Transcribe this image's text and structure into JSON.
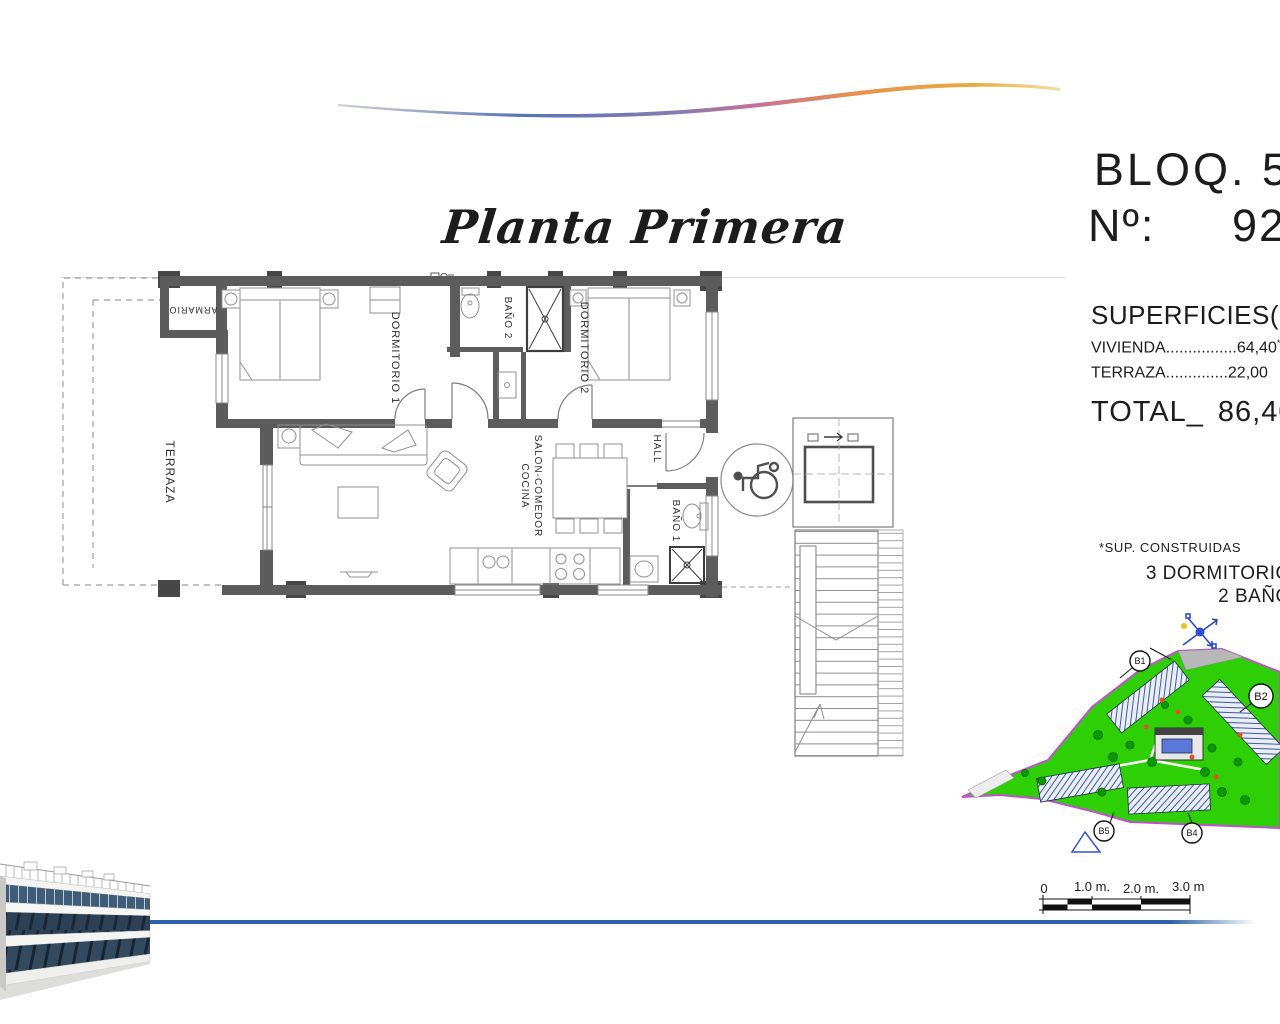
{
  "header": {
    "title": "Planta Primera"
  },
  "unit": {
    "block": "BLOQ. 5",
    "number_label": "Nº:",
    "number_value": "92"
  },
  "surfaces": {
    "title": "SUPERFICIES(M2)",
    "rows": [
      {
        "label": "VIVIENDA",
        "leader": "................",
        "value": "64,40",
        "note": "*"
      },
      {
        "label": "TERRAZA",
        "leader": "..............",
        "value": "22,00",
        "note": ""
      }
    ],
    "total_label": "TOTAL",
    "total_separator": "_",
    "total_value": "86,40",
    "footnote": "*SUP. CONSTRUIDAS",
    "features": [
      "3 DORMITORIOS",
      "2 BAÑOS"
    ]
  },
  "floor_plan": {
    "labels": {
      "terraza": "TERRAZA",
      "armario": "ARMARIO",
      "dormitorio1": "DORMITORIO 1",
      "bano2": "BAÑO 2",
      "dormitorio2": "DORMITORIO 2",
      "salon": "SALON-COMEDOR",
      "cocina": "COCINA",
      "hall": "HALL",
      "bano1": "BAÑO 1"
    }
  },
  "site_plan": {
    "building_labels": {
      "b1": "B1",
      "b2": "B2",
      "b4": "B4",
      "b5": "B5"
    },
    "colors": {
      "grass": "#2fcf06",
      "outline": "#c050d0",
      "pool": "#5a78d8",
      "tree": "#0b9900"
    }
  },
  "scale_bar": {
    "labels": [
      "0",
      "1.0 m.",
      "2.0 m.",
      "3.0 m."
    ]
  },
  "decor": {
    "swoosh_colors": [
      "#9aa0ad",
      "#5872b8",
      "#c76f95",
      "#e8924d",
      "#e6b94f"
    ],
    "baseline_color": "#2b63a9"
  }
}
